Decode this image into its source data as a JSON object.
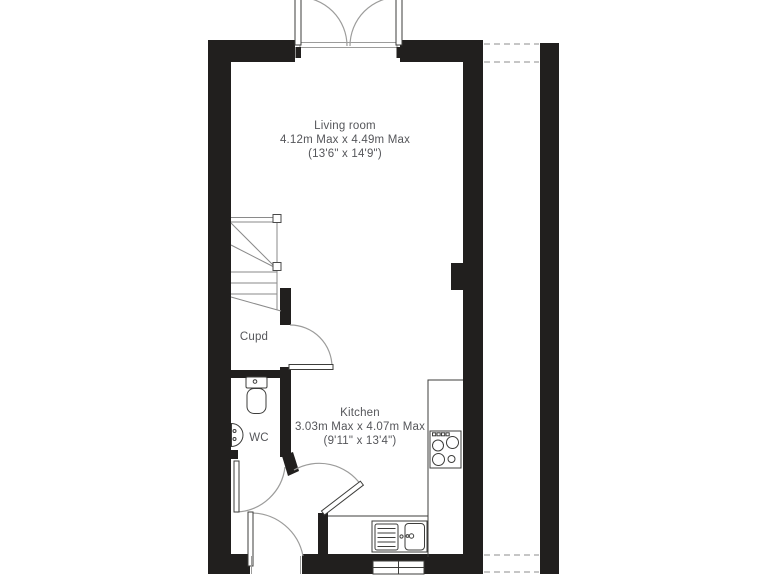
{
  "floorplan": {
    "rooms": [
      {
        "name": "Living room",
        "dims_metric": "4.12m Max x 4.49m Max",
        "dims_imperial": "(13'6\" x 14'9\")"
      },
      {
        "name": "Kitchen",
        "dims_metric": "3.03m Max x 4.07m Max",
        "dims_imperial": "(9'11\" x 13'4\")"
      },
      {
        "name": "Cupd"
      },
      {
        "name": "WC"
      }
    ],
    "fixtures": [
      "french-doors",
      "stairs",
      "cupboard-door",
      "wc-door",
      "kitchen-door",
      "front-door",
      "toilet",
      "basin",
      "kitchen-sink",
      "hob",
      "window",
      "worktop",
      "dashed-passage"
    ],
    "colors": {
      "wall": "#211f1e",
      "label_text": "#55565a",
      "door_arc": "#9c9c9b",
      "fixture_line": "#3d3d3b",
      "stair_line": "#8a8a8a",
      "dashed_line": "#b3b3b3"
    }
  }
}
